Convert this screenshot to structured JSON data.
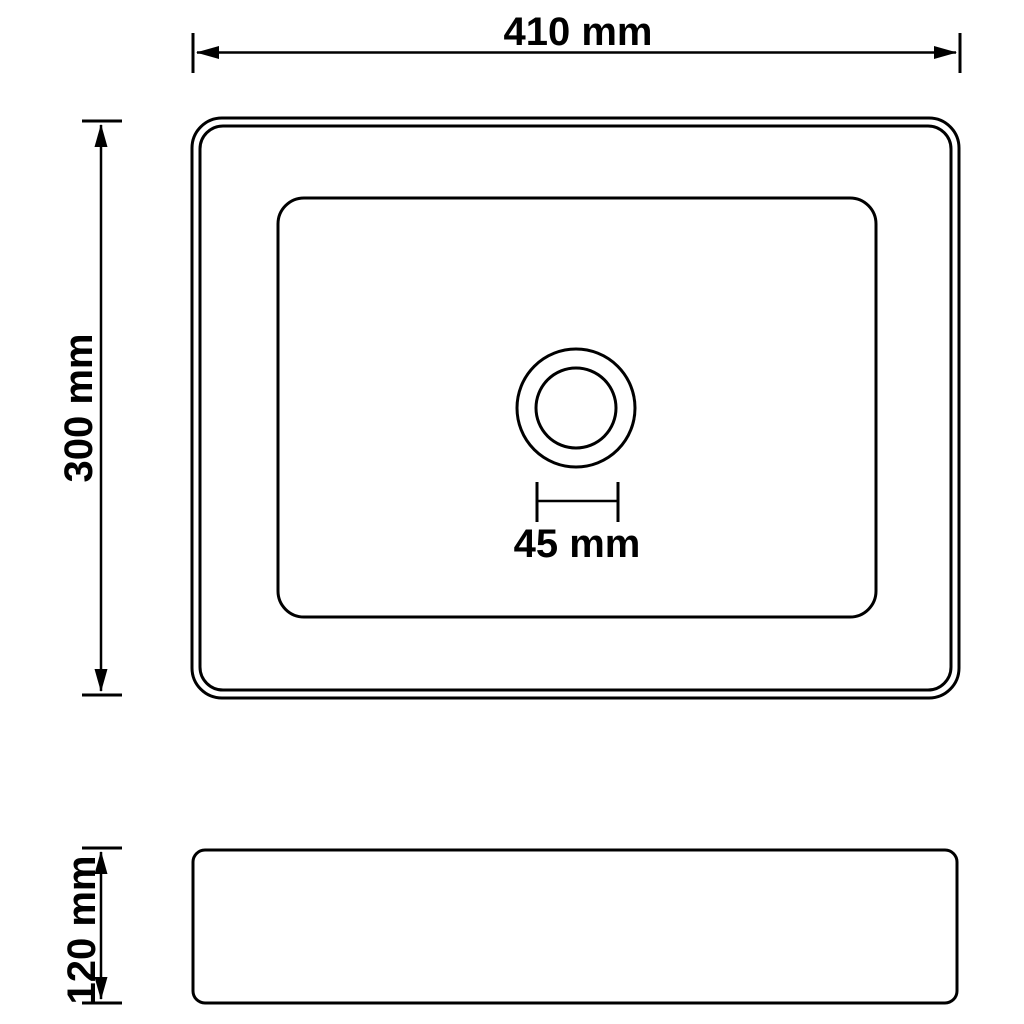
{
  "colors": {
    "background": "#ffffff",
    "line": "#000000",
    "text": "#000000"
  },
  "drawing": {
    "subject": "washbasin-technical-drawing",
    "views": [
      "top-view",
      "side-view"
    ]
  },
  "dimensions": {
    "width": {
      "label": "410 mm",
      "value": 410,
      "unit": "mm"
    },
    "depth": {
      "label": "300 mm",
      "value": 300,
      "unit": "mm"
    },
    "drain_diameter": {
      "label": "45 mm",
      "value": 45,
      "unit": "mm"
    },
    "height": {
      "label": "120 mm",
      "value": 120,
      "unit": "mm"
    }
  }
}
